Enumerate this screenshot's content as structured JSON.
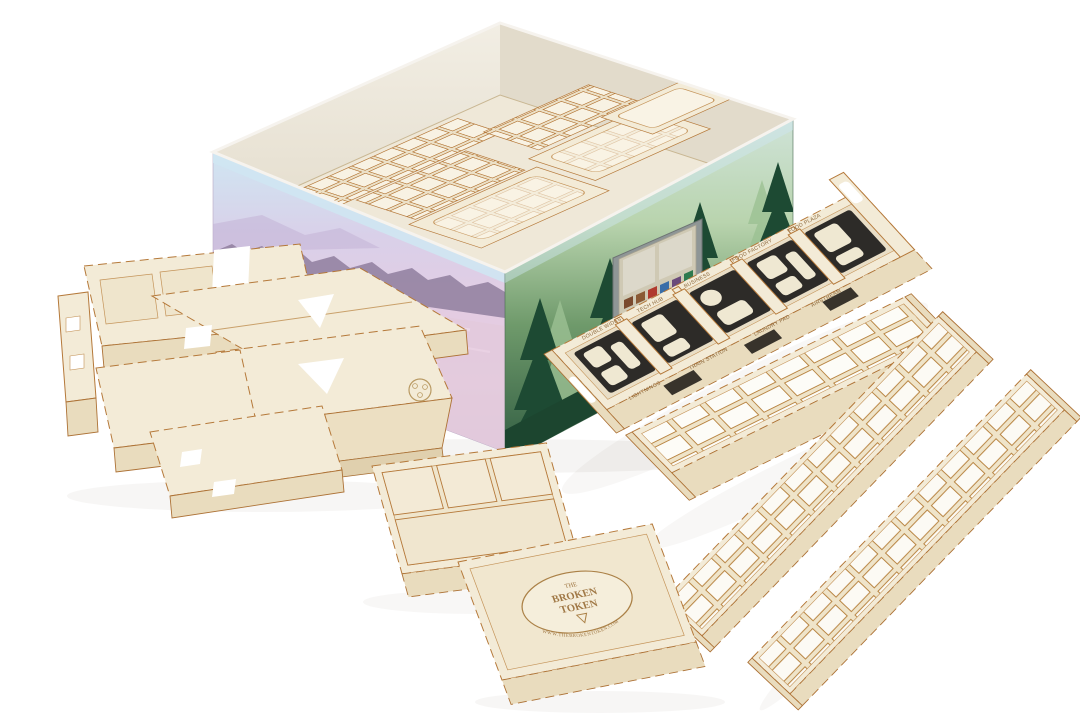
{
  "palette": {
    "wood_top": "#f3ebd7",
    "wood_side": "#e9dcbe",
    "cut_edge_brown": "#b5793a",
    "foam_black": "#2d2b28",
    "box_interior": "#ece7db",
    "art_sky": "#cfe6f2",
    "art_lavender": "#dccfe8",
    "art_pink": "#e7cede",
    "art_forest_light": "#cfe3c3",
    "art_forest_dark": "#2e5a40",
    "background": "#ffffff"
  },
  "foam_tray": {
    "back_rim_labels": [
      "DOUBLE WIDES",
      "TECH HUB",
      "BUSINESS",
      "FOOD FACTORY",
      "FOOD PLAZA"
    ],
    "front_rim_labels": [
      "LIGHTNINGS",
      "TRAIN STATION",
      "LAUNDRY PAD",
      "AIRSTREAM"
    ]
  },
  "brand": {
    "the": "THE",
    "name1": "BROKEN",
    "name2": "TOKEN",
    "website": "WWW.THEBROKENTOKEN.COM"
  }
}
